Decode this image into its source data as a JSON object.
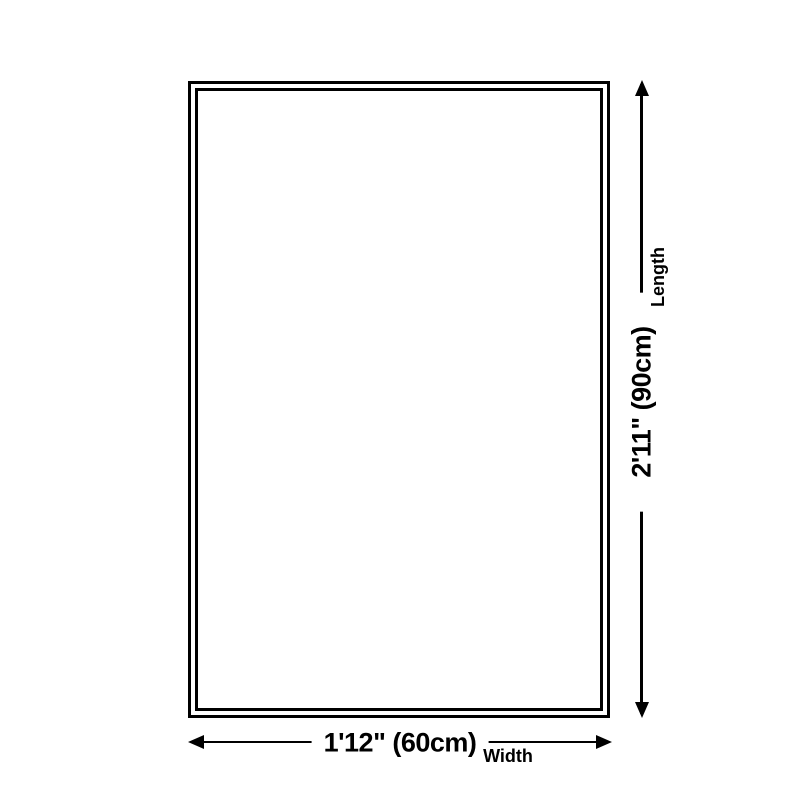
{
  "diagram": {
    "type": "product-dimension-diagram",
    "colors": {
      "background": "#ffffff",
      "line": "#000000",
      "text": "#000000"
    },
    "length_dimension": {
      "value": "2'11\" (90cm)",
      "label": "Length"
    },
    "width_dimension": {
      "value": "1'12\" (60cm)",
      "label": "Width"
    }
  }
}
